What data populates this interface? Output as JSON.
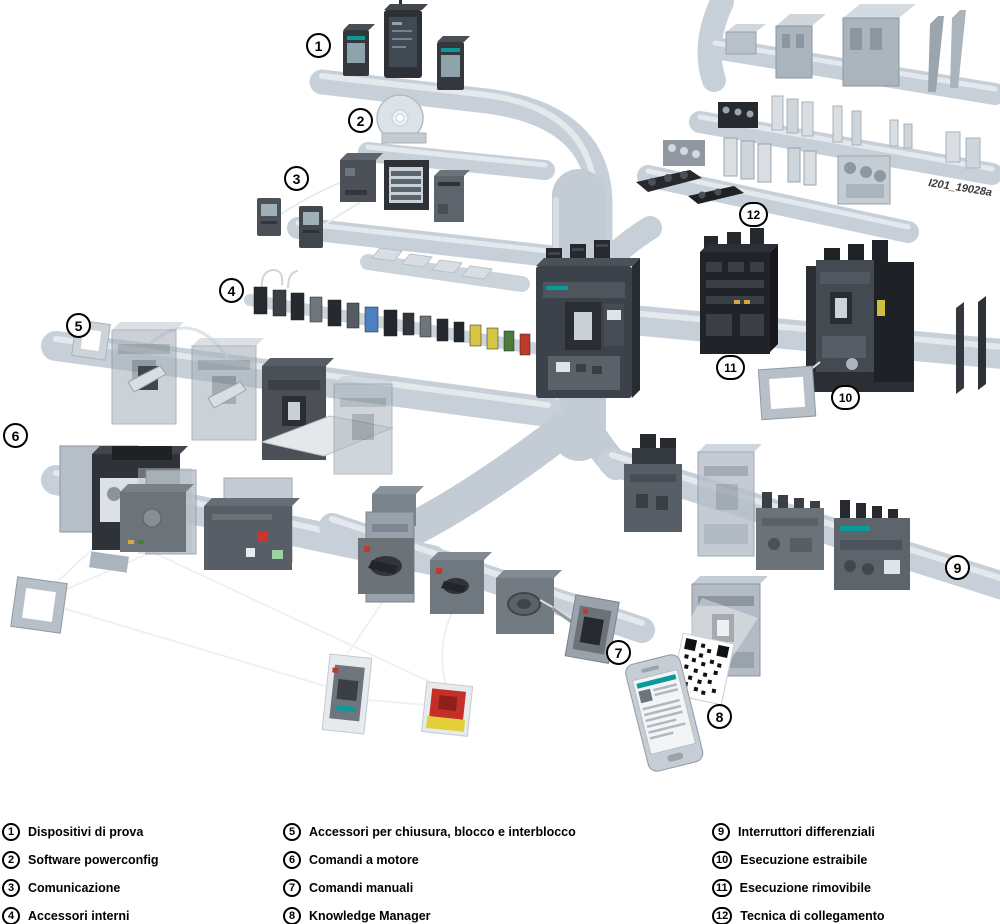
{
  "watermark": "I201_19028a",
  "callouts": [
    "1",
    "2",
    "3",
    "4",
    "5",
    "6",
    "7",
    "8",
    "9",
    "10",
    "11",
    "12"
  ],
  "legend": {
    "items": [
      {
        "num": "1",
        "label": "Dispositivi di prova"
      },
      {
        "num": "2",
        "label": "Software powerconfig"
      },
      {
        "num": "3",
        "label": "Comunicazione"
      },
      {
        "num": "4",
        "label": "Accessori interni"
      },
      {
        "num": "5",
        "label": "Accessori per chiusura, blocco e interblocco"
      },
      {
        "num": "6",
        "label": "Comandi a motore"
      },
      {
        "num": "7",
        "label": "Comandi manuali"
      },
      {
        "num": "8",
        "label": "Knowledge Manager"
      },
      {
        "num": "9",
        "label": "Interruttori differenziali"
      },
      {
        "num": "10",
        "label": "Esecuzione estraibile"
      },
      {
        "num": "11",
        "label": "Esecuzione rimovibile"
      },
      {
        "num": "12",
        "label": "Tecnica di collegamento"
      }
    ]
  },
  "colors": {
    "rail": "#c7d0d8",
    "rail_highlight": "#e4e9ed",
    "device_dark": "#2e3236",
    "device_mid": "#6b7379",
    "device_light": "#aab3bb",
    "breaker_body": "#3c4249",
    "accent_teal": "#0a9a9a",
    "alert_red": "#c43028",
    "warn_yellow": "#e3cf3a",
    "ghost": "#b6bfc7"
  }
}
